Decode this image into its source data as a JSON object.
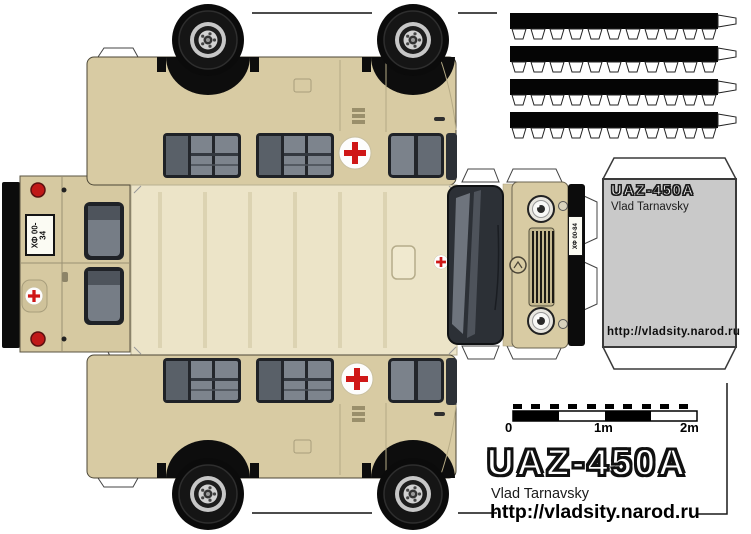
{
  "colors": {
    "page_bg": "#ffffff",
    "body_beige": "#d8cba3",
    "roof_beige": "#ece4c8",
    "glass_dark": "#2c3036",
    "glass_light": "#7d848d",
    "red_cross": "#cf1717",
    "tail_light_red": "#c01818",
    "box_gray": "#c9c9c9",
    "tire_black": "#0b0b0b"
  },
  "license_plates": {
    "rear": "ХФ 00-34",
    "front": "ХФ 00-84"
  },
  "box_label": {
    "title": "UAZ-450A",
    "author": "Vlad Tarnavsky",
    "url": "http://vladsity.narod.ru"
  },
  "scale_bar": {
    "labels": [
      "0",
      "1m",
      "2m"
    ]
  },
  "footer": {
    "title": "UAZ-450A",
    "author": "Vlad Tarnavsky",
    "url": "http://vladsity.narod.ru"
  }
}
